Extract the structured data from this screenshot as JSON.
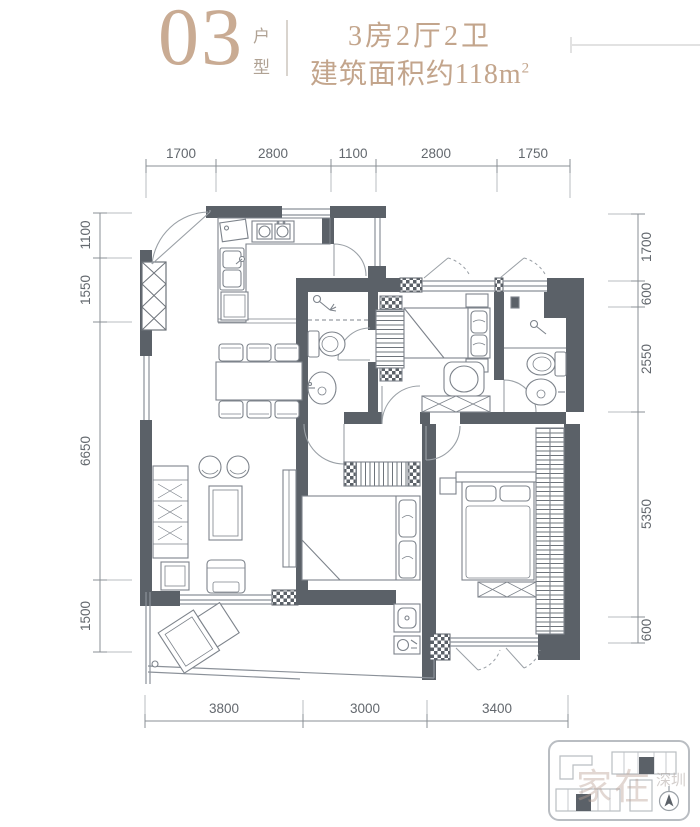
{
  "header": {
    "unit_number": "03",
    "unit_label_1": "户",
    "unit_label_2": "型",
    "layout_spec": "3房2厅2卫",
    "area_text": "建筑面积约118m",
    "area_sup": "2"
  },
  "dimensions": {
    "top": [
      "1700",
      "2800",
      "1100",
      "2800",
      "1750"
    ],
    "bottom": [
      "3800",
      "3000",
      "3400"
    ],
    "left": [
      "1100",
      "1550",
      "6650",
      "1500"
    ],
    "right": [
      "1700",
      "600",
      "2550",
      "5350",
      "600"
    ]
  },
  "watermark": {
    "text_main": "家在",
    "text_sub": "深圳"
  },
  "colors": {
    "accent_tan": "#c3a58c",
    "wall": "#5b6168",
    "dimension": "#63686e"
  }
}
